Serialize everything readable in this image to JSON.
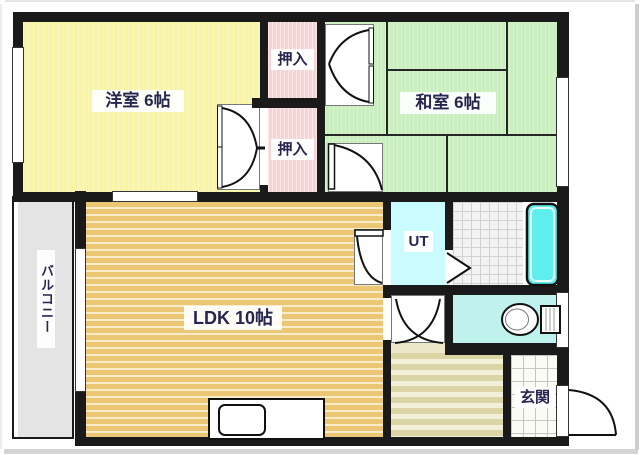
{
  "plan_title": "apartment-floorplan",
  "rooms": {
    "western_room": "洋室 6帖",
    "japanese_room": "和室 6帖",
    "ldk": "LDK 10帖",
    "closet_upper": "押入",
    "closet_lower": "押入",
    "utility": "UT",
    "entrance": "玄関",
    "balcony": "バルコニー"
  },
  "colors": {
    "wall": "#1a1a1a",
    "western_room_fill": "#f8f4aa",
    "japanese_room_fill": "#cbeec1",
    "closet_fill": "#f7d4d4",
    "ldk_wood_dark": "#ebc775",
    "ldk_wood_light": "#f7ecca",
    "hall_wood_dark": "#dbd5a6",
    "hall_wood_light": "#f3f0da",
    "utility_fill": "#c9fbff",
    "toilet_room_fill": "#bff2ec",
    "bathtub_fill": "#5eeeee",
    "balcony_fill": "#e4e4e4",
    "label_text": "#26264f"
  },
  "fixtures": {
    "bathtub": "bathtub-icon",
    "toilet": "toilet-icon",
    "kitchen_sink": "kitchen-sink-icon",
    "folding_door": "folding-door-icon",
    "entrance_door": "entrance-door-arc"
  }
}
